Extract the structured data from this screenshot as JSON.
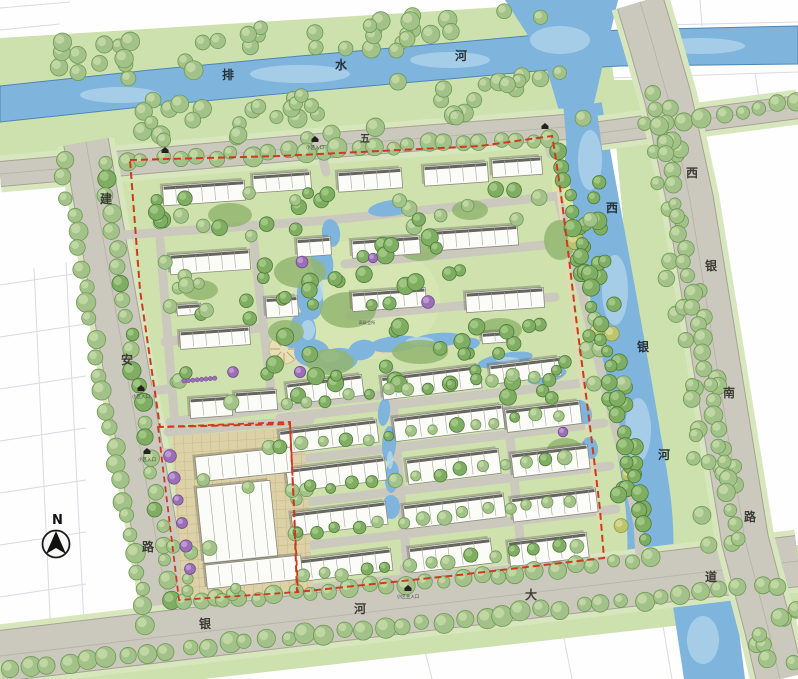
{
  "colors": {
    "road": "#cbc8bd",
    "road_edge": "#a7a396",
    "road_center": "#b7b3a6",
    "verge": "#d8e6bd",
    "water": "#7fb4dd",
    "water_light": "#bcdaee",
    "water_edge": "#4e86b4",
    "site_green": "#cfe2ad",
    "band_green": "#cde1ae",
    "lawn": "#dcea9e",
    "paving": "#ddd1a8",
    "paving_line": "#c9bb8d",
    "building_fill": "#fbfbf8",
    "building_edge": "#8a8a80",
    "roof_dark": "#4a4a42",
    "boundary_red": "#cf3a1f",
    "parcel_line": "#d9dae3",
    "label_dark": "#26323a",
    "label_road": "#3c3c35",
    "mass_green": "#93b571"
  },
  "labels": {
    "river_top": {
      "name": "排水河",
      "chars": [
        {
          "ch": "排",
          "x": 228,
          "y": 79
        },
        {
          "ch": "水",
          "x": 341,
          "y": 69
        },
        {
          "ch": "河",
          "x": 461,
          "y": 60
        }
      ]
    },
    "river_right": {
      "name": "西银河",
      "chars": [
        {
          "ch": "西",
          "x": 612,
          "y": 212
        },
        {
          "ch": "银",
          "x": 643,
          "y": 351
        },
        {
          "ch": "河",
          "x": 664,
          "y": 459
        }
      ]
    },
    "road_left": {
      "name": "建安路",
      "chars": [
        {
          "ch": "建",
          "x": 106,
          "y": 203
        },
        {
          "ch": "安",
          "x": 127,
          "y": 364
        },
        {
          "ch": "路",
          "x": 148,
          "y": 551
        }
      ]
    },
    "road_bottom": {
      "name": "银河大道",
      "chars": [
        {
          "ch": "银",
          "x": 205,
          "y": 628
        },
        {
          "ch": "河",
          "x": 360,
          "y": 613
        },
        {
          "ch": "大",
          "x": 531,
          "y": 599
        },
        {
          "ch": "道",
          "x": 711,
          "y": 581
        }
      ]
    },
    "road_right": {
      "name": "西银南路",
      "chars": [
        {
          "ch": "西",
          "x": 692,
          "y": 177
        },
        {
          "ch": "银",
          "x": 711,
          "y": 270
        },
        {
          "ch": "南",
          "x": 729,
          "y": 397
        },
        {
          "ch": "路",
          "x": 750,
          "y": 521
        }
      ]
    },
    "road_top_partial": {
      "name": "五",
      "chars": [
        {
          "ch": "五",
          "x": 365,
          "y": 142
        }
      ]
    },
    "clubhouse": {
      "name": "高级会所",
      "x": 367,
      "y": 324
    },
    "compass_n": "N"
  },
  "entrances": [
    {
      "label": "小区入口",
      "x": 315,
      "y": 140
    },
    {
      "label": "",
      "x": 545,
      "y": 127
    },
    {
      "label": "小区入口",
      "x": 141,
      "y": 389
    },
    {
      "label": "小区入口",
      "x": 147,
      "y": 452
    },
    {
      "label": "小区主入口",
      "x": 408,
      "y": 589
    },
    {
      "label": "",
      "x": 165,
      "y": 151
    }
  ]
}
